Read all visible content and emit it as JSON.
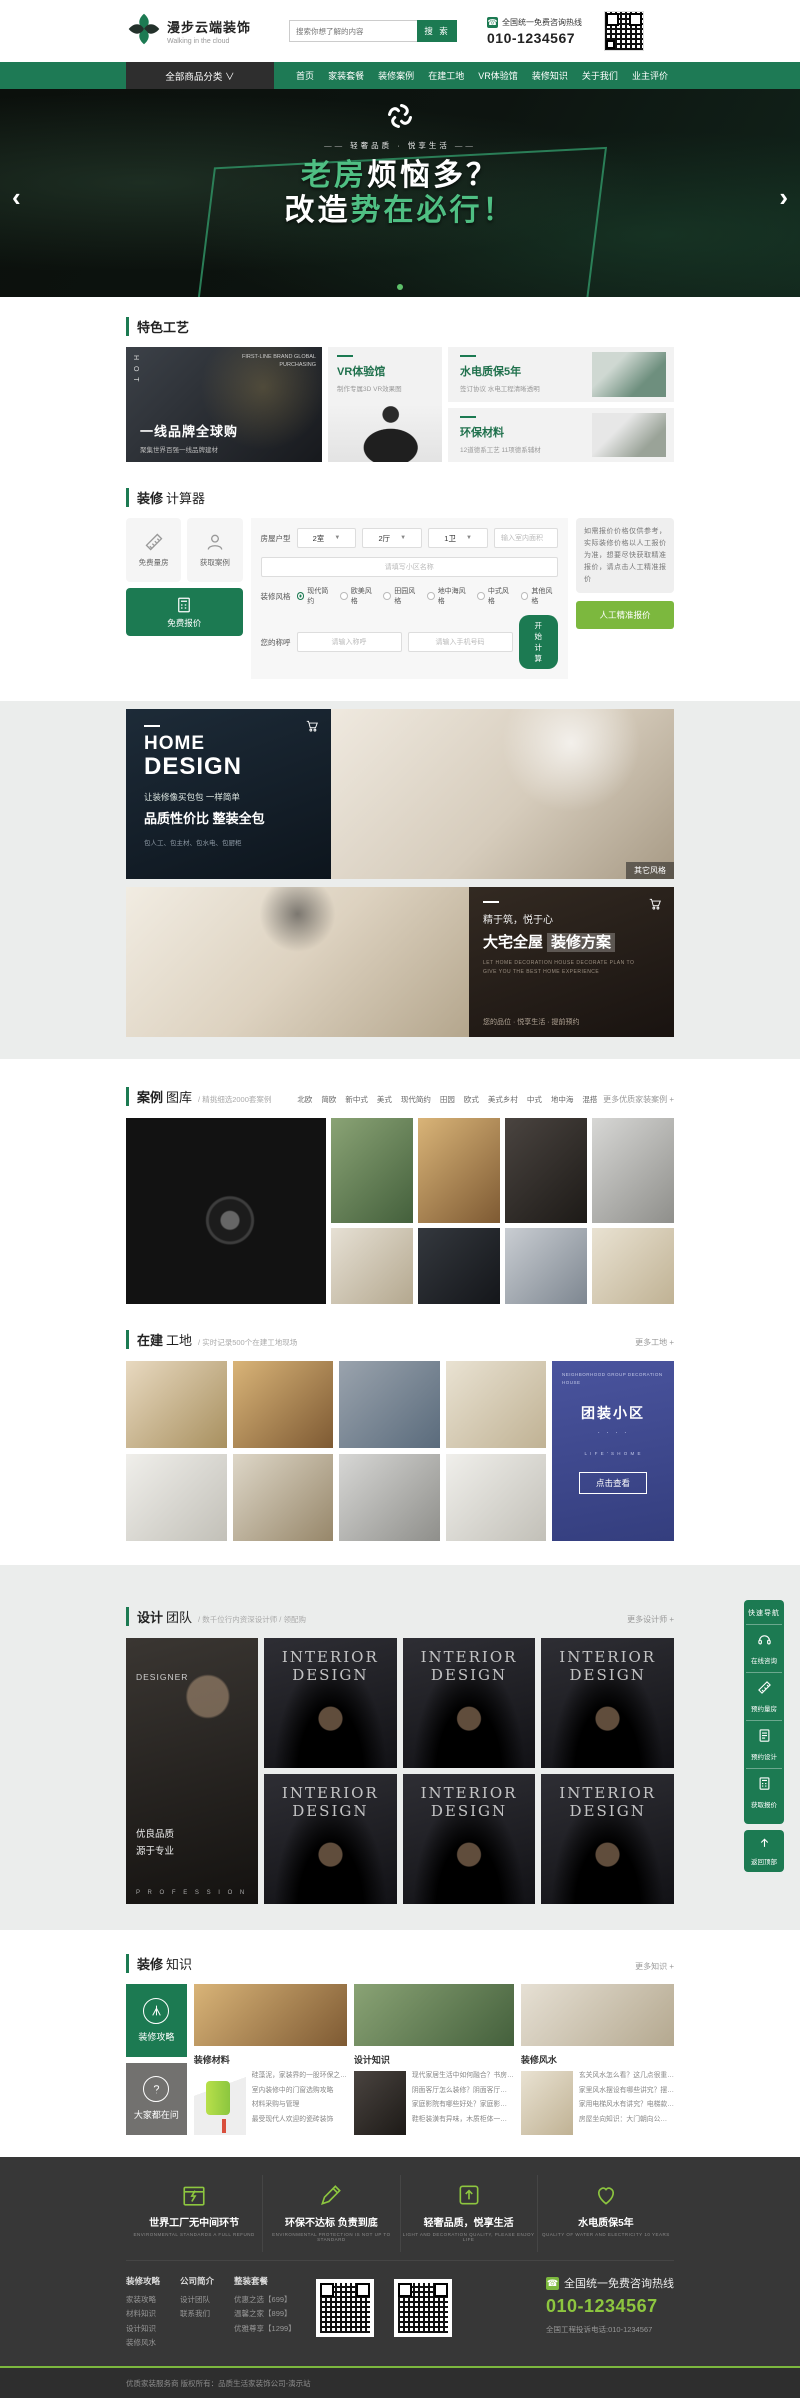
{
  "header": {
    "logo_title": "漫步云端装饰",
    "logo_subtitle": "Walking in the cloud",
    "search_placeholder": "搜索你想了解的内容",
    "search_button": "搜 索",
    "hotline_label": "全国统一免费咨询热线",
    "hotline_number": "010-1234567"
  },
  "nav": {
    "category": "全部商品分类 ∨",
    "items": [
      "首页",
      "家装套餐",
      "装修案例",
      "在建工地",
      "VR体验馆",
      "装修知识",
      "关于我们",
      "业主评价"
    ]
  },
  "hero": {
    "tagline": "轻奢品质 · 悦享生活",
    "title1_a": "老房",
    "title1_b": "烦恼多？",
    "title2_a": "改造",
    "title2_b": "势在必行！",
    "prev": "‹",
    "next": "›"
  },
  "features": {
    "section_title": "特色工艺",
    "card1": {
      "vertical": "H O T",
      "corner": "FIRST-LINE BRAND GLOBAL PURCHASING",
      "title": "一线品牌全球购",
      "subtitle": "聚集世界百强一线品牌建材"
    },
    "card2": {
      "title": "VR体验馆",
      "subtitle": "制作专属3D VR效果图"
    },
    "card3": {
      "title": "水电质保5年",
      "subtitle": "签订协议 水电工程清晰透明"
    },
    "card4": {
      "title": "环保材料",
      "subtitle": "12道德系工艺 11项德系辅材"
    }
  },
  "calculator": {
    "title_strong": "装修",
    "title_light": "计算器",
    "tile_measure": "免费量房",
    "tile_case": "获取案例",
    "tile_quote": "免费报价",
    "house_label": "房屋户型",
    "select_room": "2室",
    "select_hall": "2厅",
    "select_bath": "1卫",
    "area_placeholder": "输入室内面积",
    "community_placeholder": "请填写小区名称",
    "style_label": "装修风格",
    "styles": [
      "现代简约",
      "欧美风格",
      "田园风格",
      "地中海风格",
      "中式风格",
      "其他风格"
    ],
    "name_label": "您的称呼",
    "name_placeholder": "请输入称呼",
    "phone_placeholder": "请输入手机号码",
    "submit": "开始计算",
    "note": "如需报价价格仅供参考，实际装修价格以人工报价为准，想要尽快获取精准报价，请点击人工精准报价",
    "manual_quote": "人工精准报价"
  },
  "banner1": {
    "title1": "HOME",
    "title2": "DESIGN",
    "line1": "让装修像买包包 一样简单",
    "line2": "品质性价比 整装全包",
    "line3": "包人工、包主材、包水电、包厨柜",
    "tag": "其它风格"
  },
  "banner2": {
    "small": "精于筑，悦于心",
    "title_a": "大宅全屋",
    "title_b": "装修方案",
    "sub": "LET HOME DECORATION HOUSE DECORATE PLAN TO GIVE YOU THE BEST HOME EXPERIENCE",
    "bottom": "您的品位 · 悦享生活 · 提前预约"
  },
  "cases": {
    "title_strong": "案例",
    "title_light": "图库",
    "desc": "/ 精挑细选2000套案例",
    "filters": [
      "北欧",
      "简欧",
      "新中式",
      "美式",
      "现代简约",
      "田园",
      "欧式",
      "美式乡村",
      "中式",
      "地中海",
      "混搭"
    ],
    "more": "更多优质家装案例 +"
  },
  "sites": {
    "title_strong": "在建",
    "title_light": "工地",
    "desc": "/ 实时记录500个在建工地现场",
    "more": "更多工地 +",
    "card": {
      "eng": "NEIGHBORHOOD GROUP DECORATION HOUSE",
      "title": "团装小区",
      "dots": "· · · ·",
      "eng2": "L I F E ' S   H O M E",
      "button": "点击查看"
    }
  },
  "team": {
    "title_strong": "设计",
    "title_light": "团队",
    "desc": "/ 数千位行内资深设计师 / 领配购",
    "more": "更多设计师 +",
    "designer": {
      "top": "DESIGNER",
      "line1": "优良品质",
      "line2": "源于专业",
      "bottom": "P R O F E S S I O N"
    },
    "portrait_line1": "INTERIOR",
    "portrait_line2": "DESIGN"
  },
  "knowledge": {
    "title_strong": "装修",
    "title_light": "知识",
    "more": "更多知识 +",
    "tile1": "装修攻略",
    "tile2": "大家都在问",
    "col1": {
      "title": "装修材料",
      "items": [
        "硅藻泥，家装界的一股环保之…",
        "室内装修中的门窗选购攻略",
        "材料采购与管理",
        "最受现代人欢迎的瓷砖装饰"
      ]
    },
    "col2": {
      "title": "设计知识",
      "items": [
        "现代家居生活中如何融合？书房…",
        "阴面客厅怎么装修？阴面客厅…",
        "家庭影院有哪些好处？家庭影…",
        "鞋柜装潢有异味，木质柜体一…"
      ]
    },
    "col3": {
      "title": "装修风水",
      "items": [
        "玄关风水怎么看？这几点很重…",
        "家里风水摆设有哪些讲究？摆…",
        "家用电梯风水有讲究？电梯款…",
        "房屋坐向知识：大门朝向公…"
      ]
    }
  },
  "footer": {
    "features": [
      {
        "title": "世界工厂无中间环节",
        "sub": "ENVIRONMENTAL STANDARDS A FULL REFUND"
      },
      {
        "title": "环保不达标 负责到底",
        "sub": "ENVIRONMENTAL PROTECTION IS NOT UP TO STANDARD"
      },
      {
        "title": "轻奢品质，悦享生活",
        "sub": "LIGHT AND DECORATION QUALITY, PLEASE ENJOY LIFE"
      },
      {
        "title": "水电质保5年",
        "sub": "QUALITY OF WATER AND ELECTRICITY 10 YEARS"
      }
    ],
    "col1": {
      "title": "装修攻略",
      "links": [
        "家装攻略",
        "材料知识",
        "设计知识",
        "装修风水"
      ]
    },
    "col2": {
      "title": "公司简介",
      "links": [
        "设计团队",
        "联系我们"
      ]
    },
    "col3": {
      "title": "整装套餐",
      "links": [
        "优惠之选【699】",
        "温馨之家【899】",
        "优雅尊享【1299】"
      ]
    },
    "hotline_label": "全国统一免费咨询热线",
    "hotline_number": "010-1234567",
    "complaint": "全国工程投诉电话:010-1234567",
    "copyright": "优质家装服务商 版权所有：品质生活家装饰公司-演示站"
  },
  "quicknav": {
    "title": "快速导航",
    "items": [
      "在线咨询",
      "预约量房",
      "预约设计",
      "获取报价"
    ],
    "back_top": "返回顶部"
  }
}
